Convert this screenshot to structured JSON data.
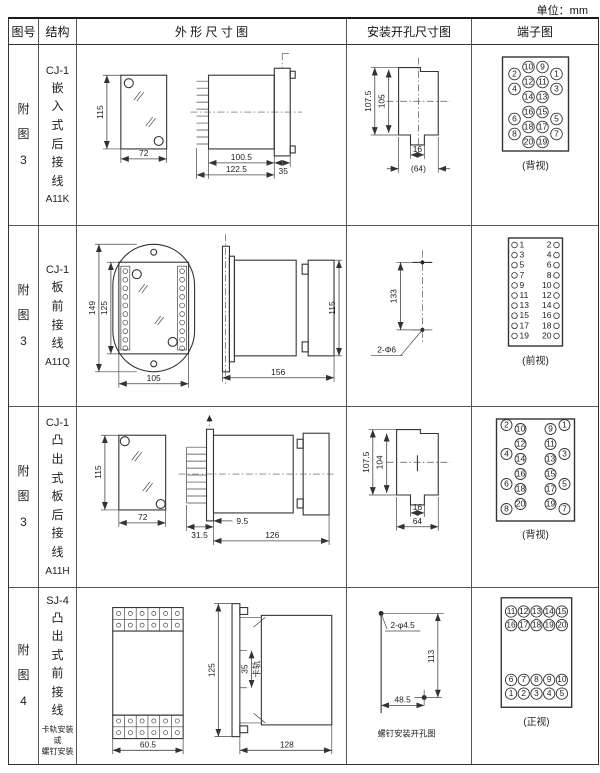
{
  "unit_note": "单位：mm",
  "header": {
    "fig": "图号",
    "structure": "结构",
    "outline": "外 形 尺 寸 图",
    "mounting": "安装开孔尺寸图",
    "terminal": "端子图"
  },
  "rows": [
    {
      "fig": "附图3",
      "model": "CJ-1",
      "structure": "嵌入式后接线",
      "code": "A11K",
      "outline": {
        "height": "115",
        "width": "72",
        "body_depth": "100.5",
        "total_depth": "122.5",
        "flange": "35"
      },
      "mounting": {
        "v_outer": "107.5",
        "v_inner": "105",
        "slot": "16",
        "width": "(64)"
      },
      "terminal": {
        "caption": "(背视)"
      }
    },
    {
      "fig": "附图3",
      "model": "CJ-1",
      "structure": "板前接线",
      "code": "A11Q",
      "outline": {
        "plate_h": "149",
        "body_h": "125",
        "width": "105",
        "depth": "156",
        "side_h": "115"
      },
      "mounting": {
        "spacing": "133",
        "holes": "2-Φ6"
      },
      "terminal": {
        "caption": "(前视)"
      }
    },
    {
      "fig": "附图3",
      "model": "CJ-1",
      "structure": "凸出式板后接线",
      "code": "A11H",
      "outline": {
        "height": "115",
        "width": "72",
        "front_depth": "31.5",
        "plate": "9.5",
        "body_depth": "126"
      },
      "mounting": {
        "v_outer": "107.5",
        "v_inner": "104",
        "slot": "16",
        "width": "64"
      },
      "terminal": {
        "caption": "(背视)"
      }
    },
    {
      "fig": "附图4",
      "model": "SJ-4",
      "structure": "凸出式前接线",
      "note1": "卡轨安装",
      "note2": "或",
      "note3": "螺钉安装",
      "outline": {
        "width": "60.5",
        "height": "125",
        "rail": "35",
        "rail_label": "卡轨",
        "depth": "128"
      },
      "mounting": {
        "holes": "2-φ4.5",
        "v": "113",
        "h": "48.5",
        "caption": "螺钉安装开孔图"
      },
      "terminal": {
        "caption": "(正视)"
      }
    }
  ],
  "terminals": {
    "t0": {
      "outer_left": [
        2,
        4,
        6,
        8
      ],
      "inner_left": [
        10,
        12,
        14,
        16,
        18,
        20
      ],
      "inner_right": [
        9,
        11,
        13,
        15,
        17,
        19
      ],
      "outer_right": [
        1,
        3,
        5,
        7
      ]
    },
    "t1": {
      "left": [
        1,
        3,
        5,
        7,
        9,
        11,
        13,
        15,
        17,
        19
      ],
      "right": [
        2,
        4,
        6,
        8,
        10,
        12,
        14,
        16,
        18,
        20
      ]
    },
    "t2": {
      "outer_left": [
        2,
        4,
        6,
        8
      ],
      "inner_left": [
        10,
        12,
        14,
        16,
        18,
        20
      ],
      "inner_right": [
        9,
        11,
        13,
        15,
        17,
        19
      ],
      "outer_right": [
        1,
        3,
        5,
        7
      ]
    },
    "t3": {
      "top_rows": [
        [
          11,
          12,
          13,
          14,
          15
        ],
        [
          16,
          17,
          18,
          19,
          20
        ]
      ],
      "bottom_rows": [
        [
          6,
          7,
          8,
          9,
          10
        ],
        [
          1,
          2,
          3,
          4,
          5
        ]
      ]
    }
  }
}
